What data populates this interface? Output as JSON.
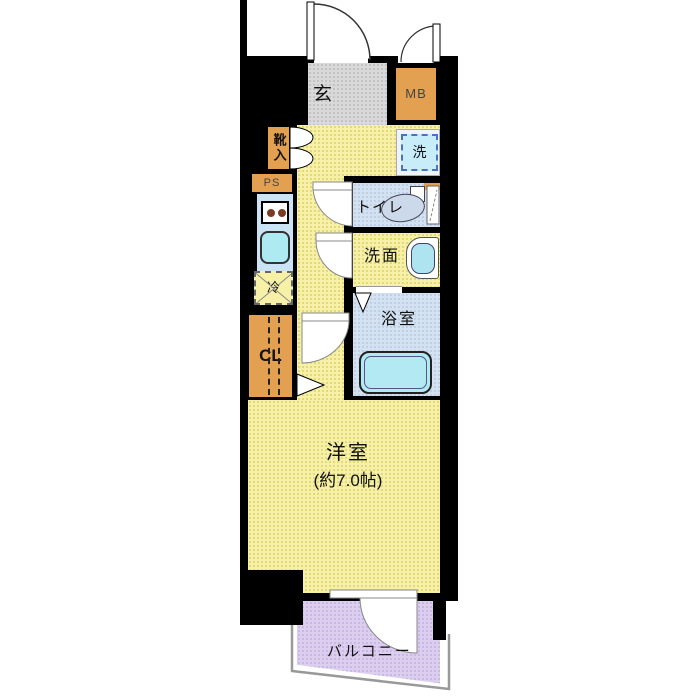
{
  "plan": {
    "rooms": {
      "genkan": {
        "label": "玄"
      },
      "meter_box": {
        "label": "MB"
      },
      "shoe_cabinet": {
        "label": "靴入"
      },
      "pipe_space": {
        "label": "PS"
      },
      "washer": {
        "label": "洗"
      },
      "toilet": {
        "label": "トイレ"
      },
      "washroom": {
        "label": "洗面"
      },
      "bathroom": {
        "label": "浴室"
      },
      "refrigerator": {
        "label": "冷"
      },
      "closet": {
        "label": "CL"
      },
      "main_room": {
        "label": "洋室",
        "size": "(約7.0帖)"
      },
      "balcony": {
        "label": "バルコニー"
      }
    },
    "colors": {
      "wall": "#000000",
      "floor_yellow": "#f6f1a7",
      "entry_gray": "#d9d9d9",
      "wet_blue": "#d4e1f1",
      "fixture_cyan": "#aee8f2",
      "cabinet_orange": "#e2a050",
      "balcony_purple": "#dbceee",
      "washer_border_blue": "#4a72c4",
      "railing_gray": "#999999"
    }
  }
}
